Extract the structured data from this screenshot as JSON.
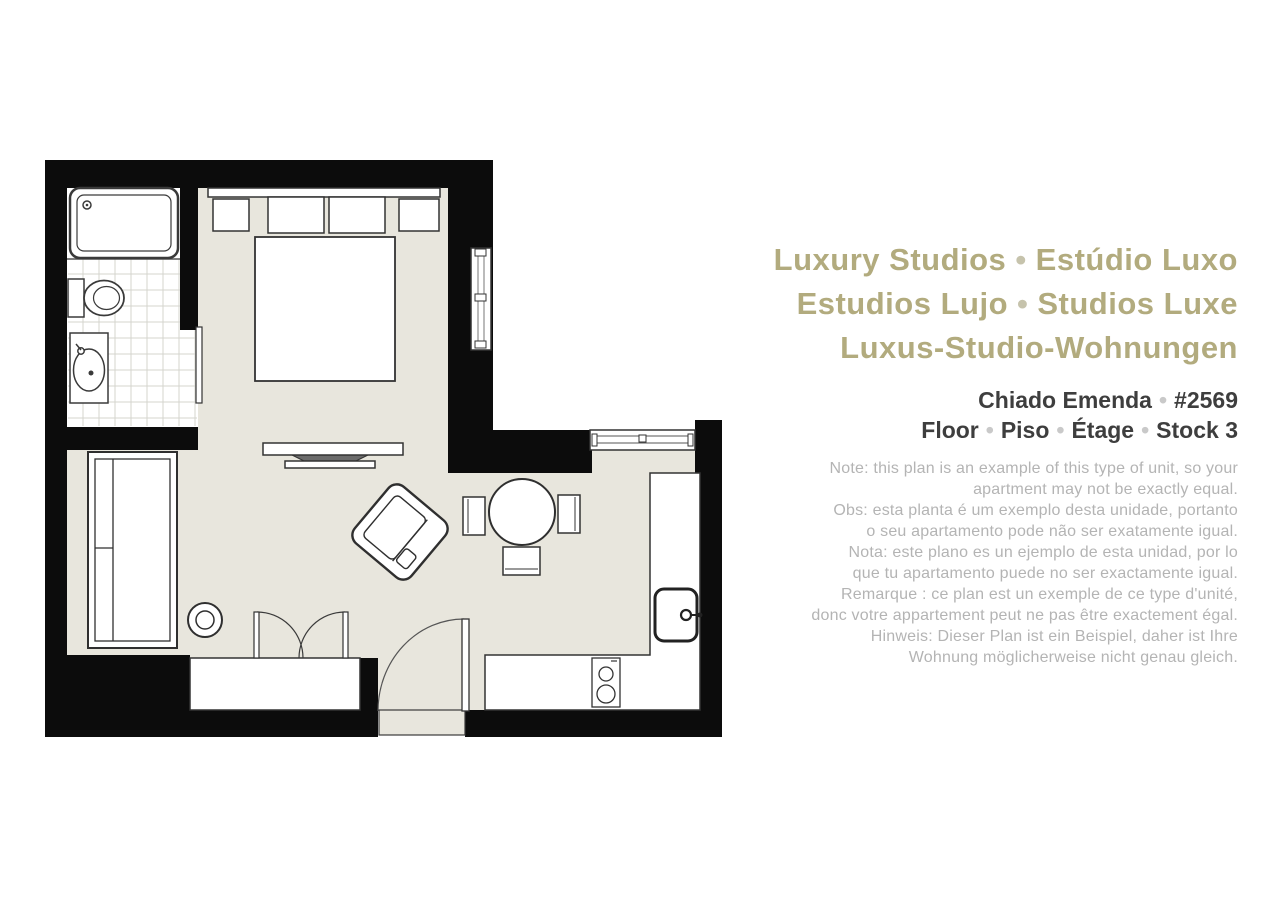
{
  "colors": {
    "title_accent": "#b2ab7e",
    "subtitle": "#3e3e3e",
    "note_text": "#b4b4b4",
    "wall": "#0c0c0c",
    "floor": "#e8e6dd"
  },
  "info": {
    "bullet": "•",
    "title": {
      "line1": {
        "a": "Luxury Studios",
        "b": "Estúdio Luxo"
      },
      "line2": {
        "a": "Estudios Lujo",
        "b": "Studios Luxe"
      },
      "line3": "Luxus-Studio-Wohnungen"
    },
    "unit": {
      "line1": {
        "a": "Chiado Emenda",
        "b": "#2569"
      },
      "line2": {
        "parts": [
          "Floor",
          "Piso",
          "Étage",
          "Stock 3"
        ]
      }
    },
    "notes": [
      "Note: this plan is an example of this type of unit, so your",
      "apartment may not be exactly equal.",
      "Obs: esta planta é um exemplo desta unidade, portanto",
      "o seu apartamento pode não ser exatamente igual.",
      "Nota: este plano es un ejemplo de esta unidad, por lo",
      "que tu apartamento puede no ser exactamente igual.",
      "Remarque : ce plan est un exemple de ce type d'unité,",
      "donc votre appartement peut ne pas être exactement égal.",
      "Hinweis: Dieser Plan ist ein Beispiel, daher ist Ihre",
      "Wohnung möglicherweise nicht genau gleich."
    ]
  },
  "floorplan": {
    "rooms": [
      "bathroom",
      "bedroom",
      "living-room",
      "kitchen"
    ],
    "fixtures": [
      "bathtub",
      "toilet",
      "bathroom-sink",
      "bathroom-door",
      "bed",
      "headboard-pillows",
      "bedroom-window",
      "tv",
      "sofa",
      "side-table",
      "armchair",
      "dining-table",
      "dining-chairs",
      "kitchen-window",
      "kitchen-counter",
      "kitchen-sink",
      "stove",
      "wardrobe",
      "french-doors",
      "entry-door"
    ]
  }
}
